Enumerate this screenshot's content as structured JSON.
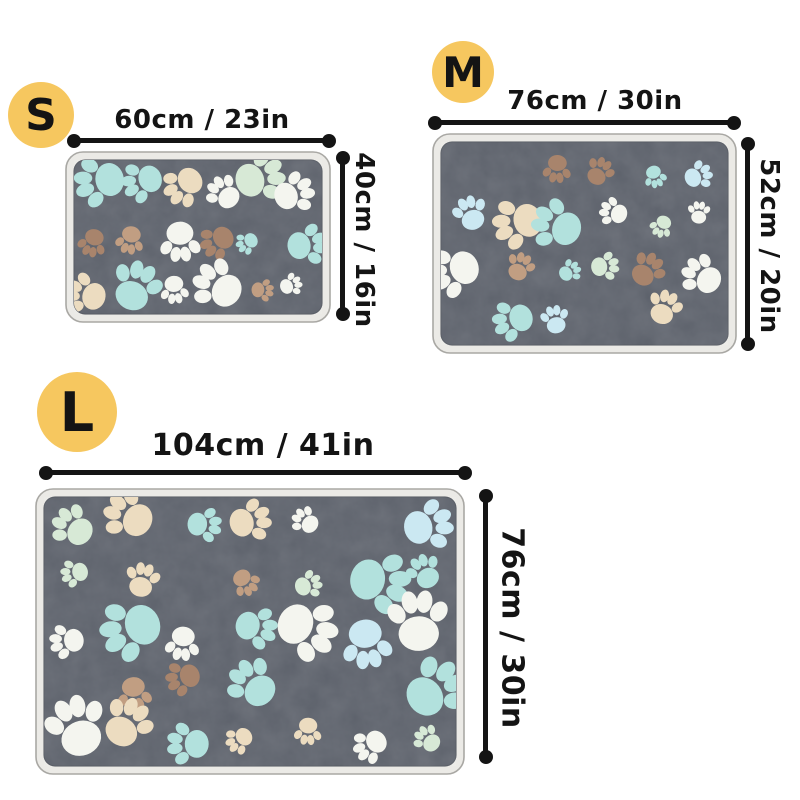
{
  "sizes": [
    {
      "badge": "S",
      "width_label": "60cm / 23in",
      "height_label": "40cm / 16in"
    },
    {
      "badge": "M",
      "width_label": "76cm / 30in",
      "height_label": "52cm / 20in"
    },
    {
      "badge": "L",
      "width_label": "104cm / 41in",
      "height_label": "76cm / 30in"
    }
  ],
  "colors": {
    "page_bg": "#ffffff",
    "badge_bg": "#f6c75f",
    "ink": "#141414",
    "mat_base": "#575c66",
    "mat_base_dark": "#4d525b",
    "mat_trim": "#ebeae6",
    "mat_trim_outline": "#a9a8a4",
    "paw_palette": [
      "#f4f5ef",
      "#ecdcc0",
      "#d7e9d6",
      "#b2e1dd",
      "#cbe8f2",
      "#c19e82",
      "#a8846c"
    ]
  }
}
